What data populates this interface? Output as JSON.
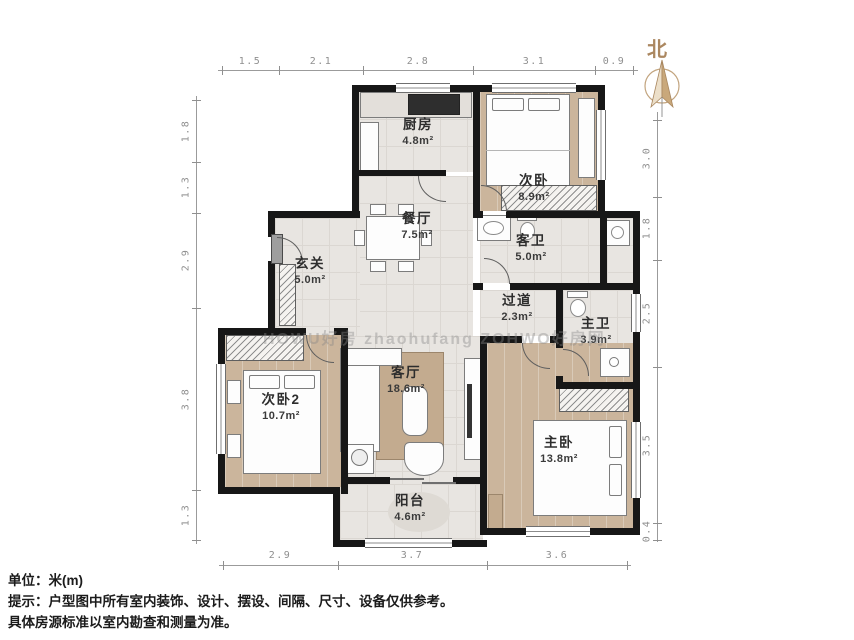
{
  "meta": {
    "north_label": "北",
    "watermark": "HOWU好房  zhaohufang  ZOHWO好房网"
  },
  "rooms": [
    {
      "name": "厨房",
      "area": "4.8m²"
    },
    {
      "name": "次卧",
      "area": "8.9m²"
    },
    {
      "name": "餐厅",
      "area": "7.5m²"
    },
    {
      "name": "客卫",
      "area": "5.0m²"
    },
    {
      "name": "玄关",
      "area": "5.0m²"
    },
    {
      "name": "过道",
      "area": "2.3m²"
    },
    {
      "name": "主卫",
      "area": "3.9m²"
    },
    {
      "name": "次卧2",
      "area": "10.7m²"
    },
    {
      "name": "客厅",
      "area": "18.6m²"
    },
    {
      "name": "主卧",
      "area": "13.8m²"
    },
    {
      "name": "阳台",
      "area": "4.6m²"
    }
  ],
  "dims": {
    "top": [
      "1.5",
      "2.1",
      "2.8",
      "3.1",
      "0.9"
    ],
    "bottom": [
      "2.9",
      "3.7",
      "3.6"
    ],
    "left": [
      "1.8",
      "1.3",
      "2.9",
      "3.8",
      "1.3"
    ],
    "right": [
      "3.0",
      "1.8",
      "2.5",
      "3.5",
      "0.4"
    ]
  },
  "footer": {
    "unit_line": "单位：米(m)",
    "tip_line1": "提示：户型图中所有室内装饰、设计、摆设、间隔、尺寸、设备仅供参考。",
    "tip_line2": "具体房源标准以室内勘查和测量为准。"
  },
  "colors": {
    "wall": "#171717",
    "tile_floor": "#e8e5e1",
    "wood_floor": "#cbb59c",
    "north_accent": "#ab8760",
    "dimension_text": "#8f8f8f"
  }
}
